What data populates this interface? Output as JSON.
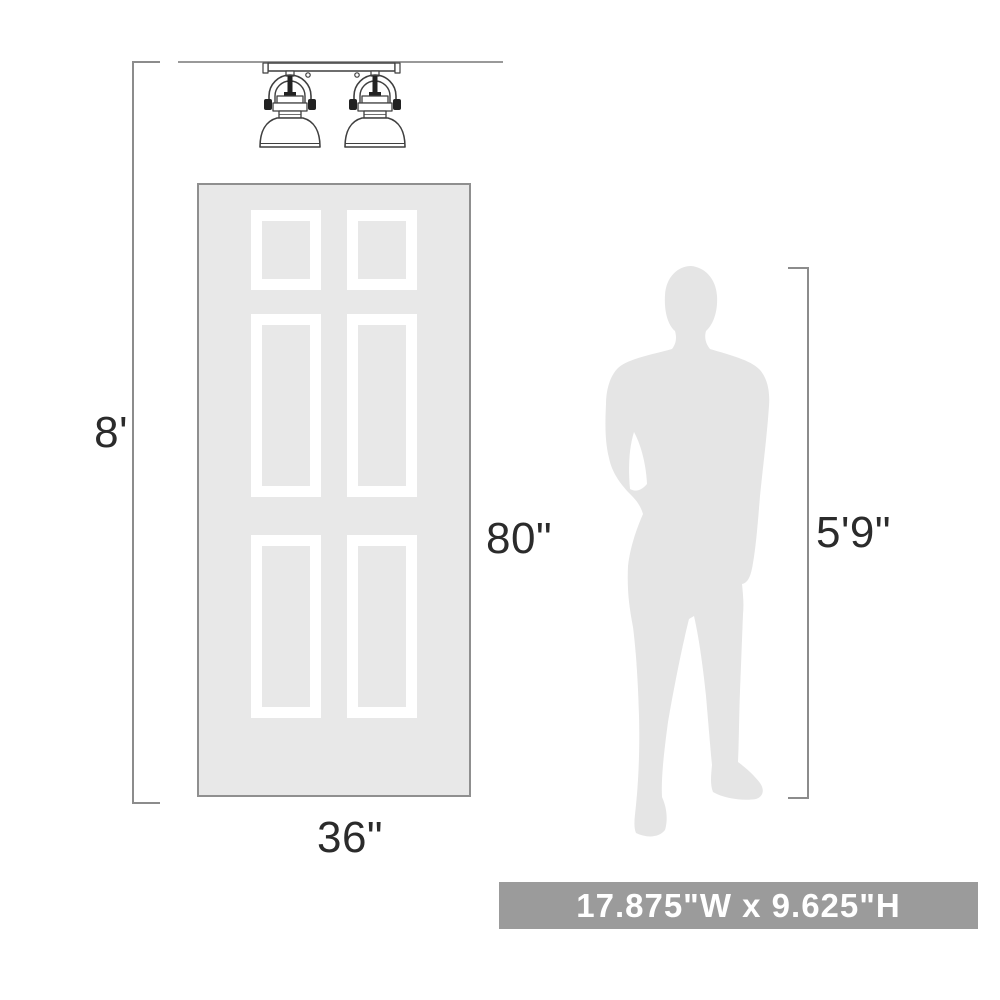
{
  "diagram": {
    "title": "product-scale-diagram",
    "ceiling": {
      "height_label": "8'"
    },
    "door": {
      "height_label": "80\"",
      "width_label": "36\"",
      "panel_count": 6
    },
    "person": {
      "height_label": "5'9\""
    },
    "fixture": {
      "type_label": "2-light semi-flush ceiling fixture"
    },
    "banner": {
      "text": "17.875\"W x 9.625\"H"
    },
    "colors": {
      "door_fill": "#e8e8e8",
      "door_border": "#8f8f8f",
      "panel_frame": "#ffffff",
      "silhouette_fill": "#e5e5e5",
      "dimension_line": "#8c8c8c",
      "fixture_stroke": "#3f3f3f",
      "label_text": "#2b2b2b",
      "banner_background": "#9b9b9b",
      "banner_text": "#ffffff"
    }
  }
}
